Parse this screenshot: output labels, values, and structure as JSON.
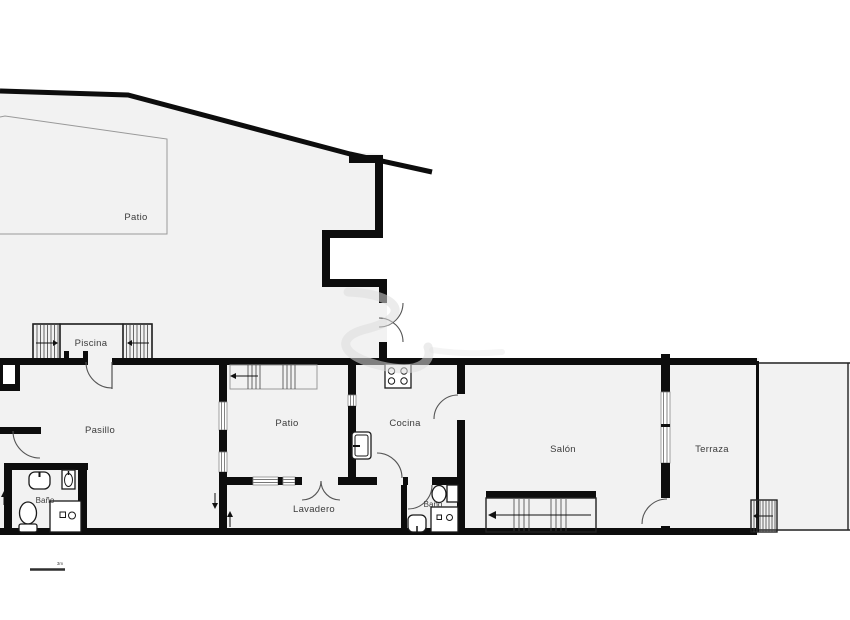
{
  "floorplan": {
    "labels": {
      "patio_garden": "Patio",
      "piscina": "Piscina",
      "pasillo": "Pasillo",
      "bano_1": "Baño",
      "patio_inner": "Patio",
      "cocina": "Cocina",
      "lavadero": "Lavadero",
      "bano_2": "Baño",
      "salon": "Salón",
      "terraza": "Terraza",
      "terraza_2": "Terraza"
    },
    "scale_label": "3m",
    "colors": {
      "wall": "#0d0d0d",
      "floor": "#f2f2f2",
      "background": "#ffffff",
      "label_text": "#3b3b3b",
      "watermark": "#dcdcdc"
    }
  }
}
